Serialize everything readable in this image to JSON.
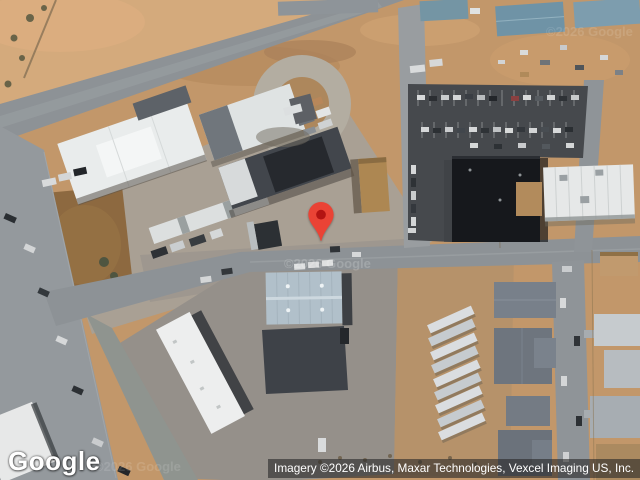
{
  "map": {
    "watermark": "©2026 Google",
    "pin": {
      "color": "#EA4335",
      "inner_color": "#B31412"
    }
  },
  "footer": {
    "logo": "Google",
    "attribution": "Imagery ©2026 Airbus, Maxar Technologies, Vexcel Imaging US, Inc."
  }
}
